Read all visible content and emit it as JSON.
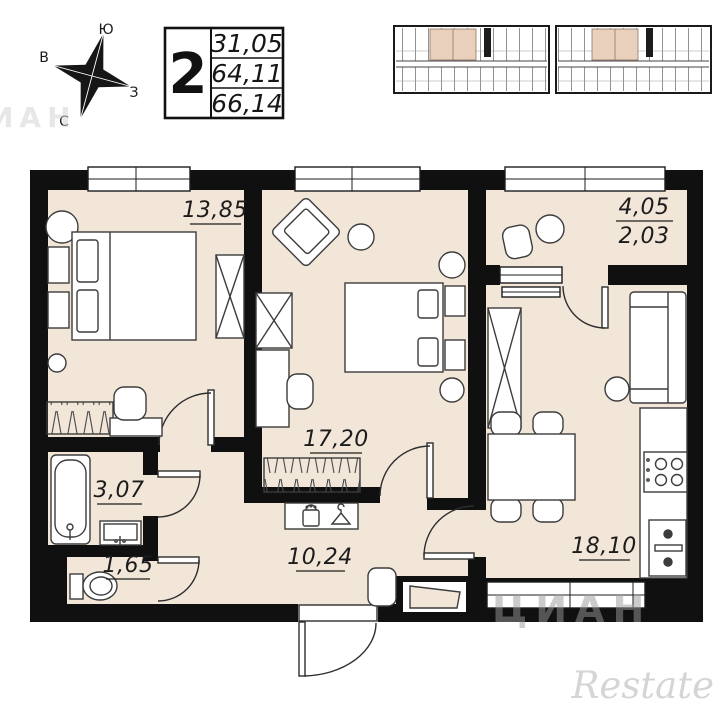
{
  "compass": {
    "top": "Ю",
    "left": "В",
    "right": "З",
    "bottom": "С"
  },
  "info_table": {
    "room_count": "2",
    "values": [
      "31,05",
      "64,11",
      "66,14"
    ]
  },
  "rooms": {
    "bedroom": {
      "area": "13,85"
    },
    "room2": {
      "area": "17,20"
    },
    "loggia": {
      "area_total": "4,05",
      "area_reduced": "2,03"
    },
    "bathroom": {
      "area": "3,07"
    },
    "wc": {
      "area": "1,65"
    },
    "hallway": {
      "area": "10,24"
    },
    "kitchen_living": {
      "area": "18,10"
    }
  },
  "watermarks": {
    "cian": "ЦИАН",
    "restate": "Restate"
  },
  "colors": {
    "wall": "#101010",
    "room_fill": "#f2e6d9",
    "highlight": "#e8d0bc",
    "furniture_stroke": "#3c3c3c",
    "door_stroke": "#2e2e2e",
    "label_text": "#1c1c1c",
    "watermark_gray": "#9a9a9a",
    "watermark_light": "#d5d5d5"
  }
}
